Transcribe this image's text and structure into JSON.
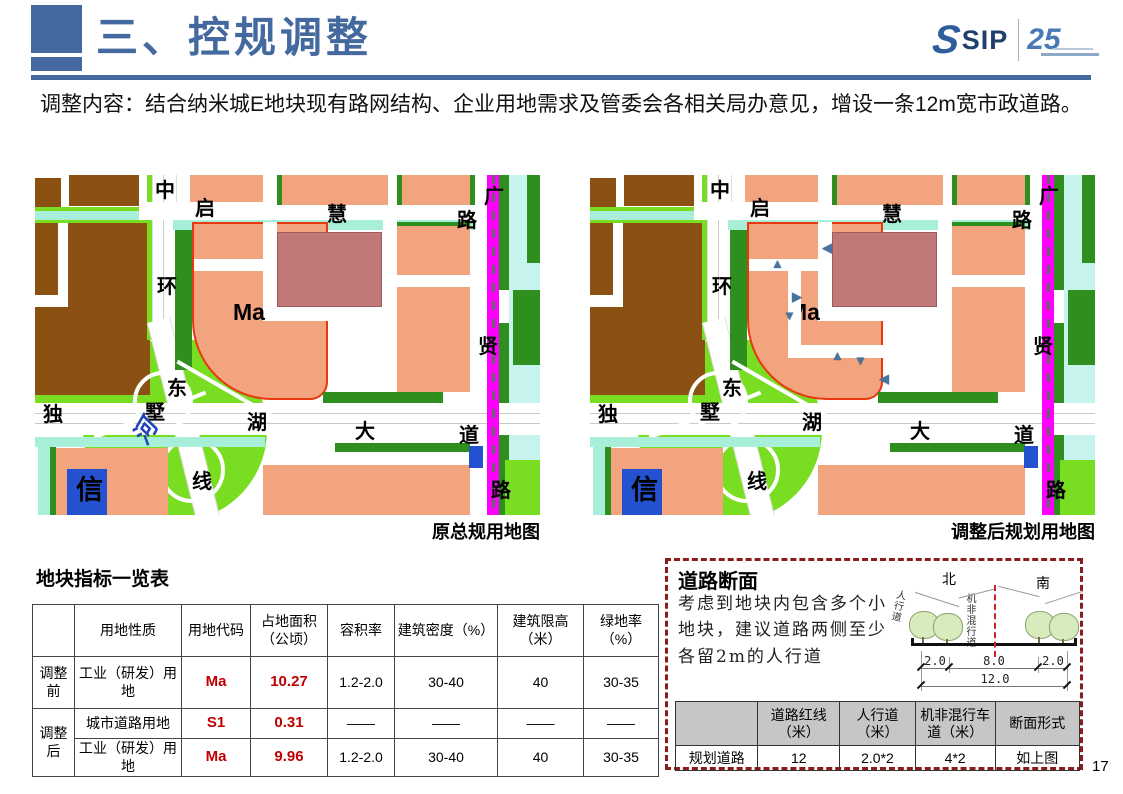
{
  "header": {
    "title": "三、控规调整"
  },
  "logo": {
    "sip": "SIP",
    "anniversary": "25"
  },
  "intro": "调整内容：结合纳米城E地块现有路网结构、企业用地需求及管委会各相关局办意见，增设一条12m宽市政道路。",
  "maps": {
    "left_caption": "原总规用地图",
    "right_caption": "调整后规划用地图",
    "labels": {
      "zhong": "中",
      "qi": "启",
      "hui": "慧",
      "lu_top": "路",
      "guang": "广",
      "huan": "环",
      "ma": "Ma",
      "xian": "贤",
      "dong": "东",
      "du": "独",
      "shu": "墅",
      "hu": "湖",
      "da": "大",
      "dao": "道",
      "xian2": "线",
      "lu_bottom": "路",
      "xin": "信"
    },
    "river": "河",
    "markers": [
      "◀",
      "▲",
      "▶",
      "▼",
      "▲",
      "▼",
      "◀"
    ]
  },
  "indicator_table": {
    "title": "地块指标一览表",
    "headers": [
      "",
      "用地性质",
      "用地代码",
      "占地面积（公顷）",
      "容积率",
      "建筑密度（%）",
      "建筑限高（米）",
      "绿地率（%）"
    ],
    "rows": [
      {
        "stage": "调整前",
        "use": "工业（研发）用地",
        "code": "Ma",
        "area": "10.27",
        "far": "1.2-2.0",
        "density": "30-40",
        "height": "40",
        "green": "30-35"
      },
      {
        "stage": "调整后",
        "use": "城市道路用地",
        "code": "S1",
        "area": "0.31",
        "far": "——",
        "density": "——",
        "height": "——",
        "green": "——"
      },
      {
        "use": "工业（研发）用地",
        "code": "Ma",
        "area": "9.96",
        "far": "1.2-2.0",
        "density": "30-40",
        "height": "40",
        "green": "30-35"
      }
    ]
  },
  "road_section": {
    "title": "道路断面",
    "note": "考虑到地块内包含多个小地块，建议道路两侧至少各留2m的人行道",
    "diagram": {
      "north": "北",
      "south": "南",
      "sidewalk": "人行道",
      "mixed_lane": "机非混行道",
      "dim_left": "2.0",
      "dim_center": "8.0",
      "dim_right": "2.0",
      "dim_total": "12.0"
    },
    "table": {
      "headers": [
        "",
        "道路红线（米）",
        "人行道（米）",
        "机非混行车道（米）",
        "断面形式"
      ],
      "rows": [
        [
          "规划道路",
          "12",
          "2.0*2",
          "4*2",
          "如上图"
        ]
      ]
    }
  },
  "page_number": "17",
  "colors": {
    "accent_blue": "#44699e",
    "table_value_red": "#c00000",
    "metro_magenta": "#ff00ff",
    "parcel_outline_red": "#e8380d"
  }
}
